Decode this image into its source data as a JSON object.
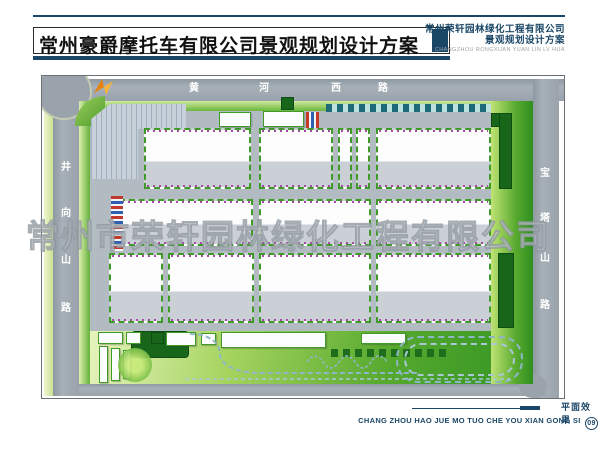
{
  "header": {
    "title": "常州豪爵摩托车有限公司景观规划设计方案",
    "company_name": "常州荣轩园林绿化工程有限公司",
    "company_subtitle": "景观规划设计方案",
    "company_pinyin": "CHANGZHOU RONGXUAN YUAN LIN LV HUA"
  },
  "map": {
    "watermark": "常州市荣轩园林绿化工程有限公司",
    "road_top": [
      "黄",
      "河",
      "西",
      "路"
    ],
    "road_left": [
      "井",
      "向",
      "山",
      "路"
    ],
    "road_right": [
      "宝",
      "塔",
      "山",
      "路"
    ]
  },
  "footer": {
    "caption": "平面效果",
    "pinyin": "CHANG ZHOU HAO JUE MO TUO CHE YOU XIAN GONG SI",
    "page_number": "09"
  },
  "colors": {
    "navy": "#1b4767",
    "road_gray": "#9aa3ab",
    "lawn_green": "#57a92e",
    "dense_green": "#17661a",
    "hedge_green": "#3f9a28",
    "flower_magenta": "#a848a8"
  }
}
